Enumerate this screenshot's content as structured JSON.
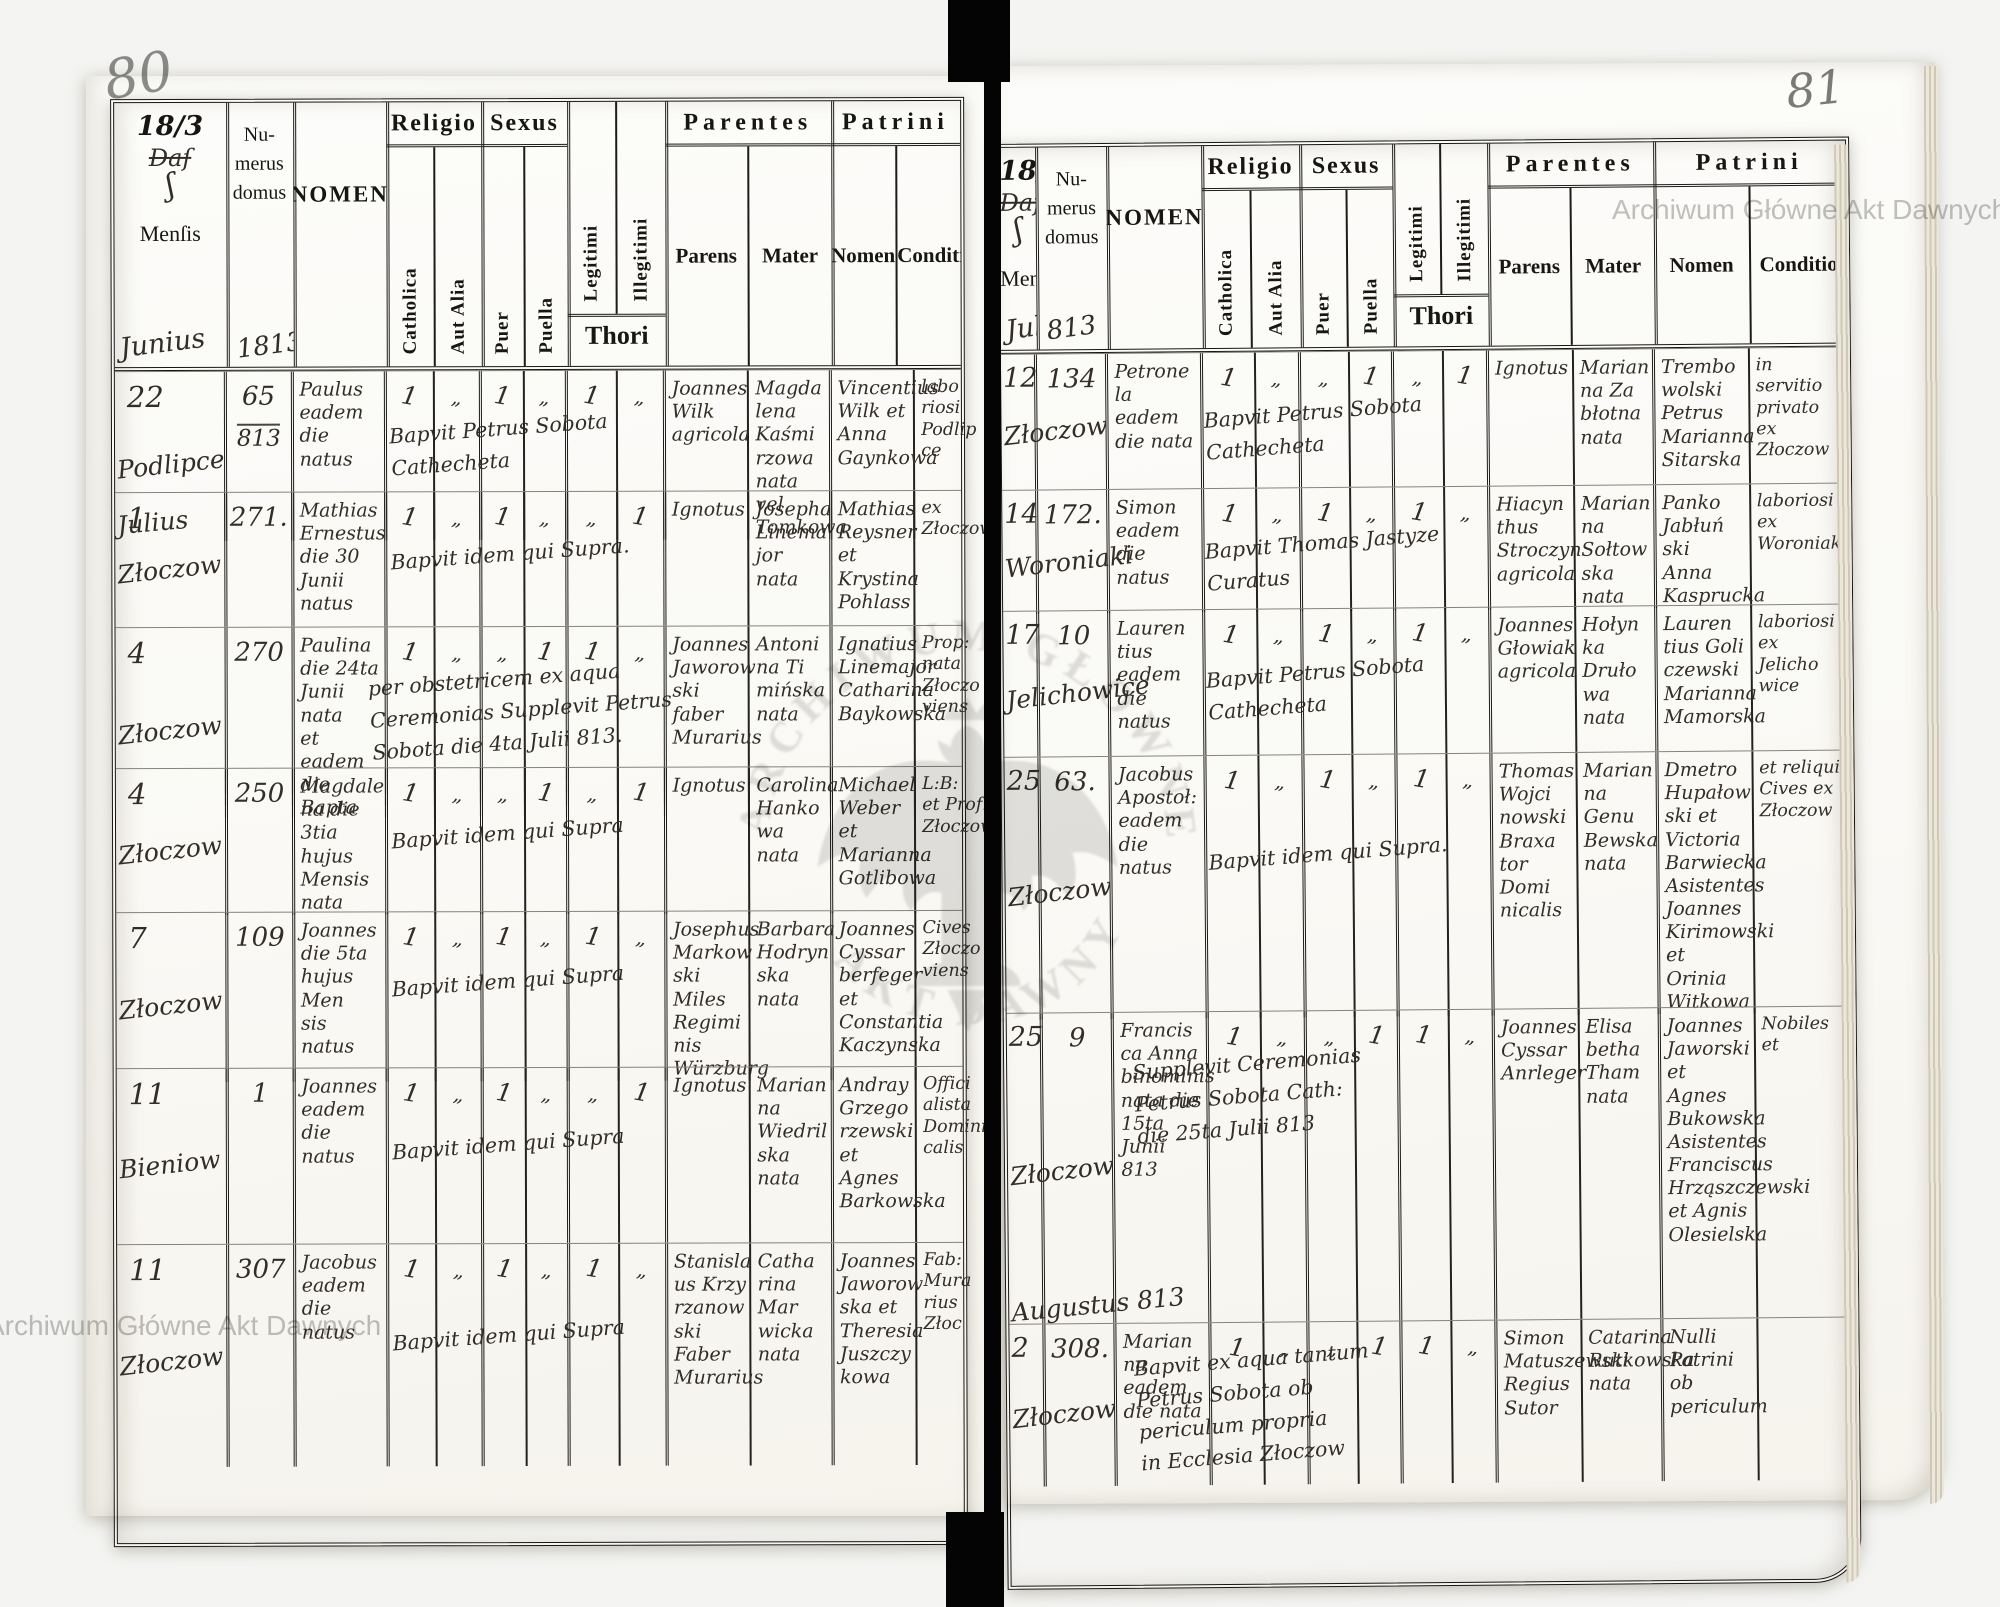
{
  "watermark": {
    "text": "Archiwum Główne Akt Dawnych",
    "emblem_top": "ARCHIWUM GŁÓWNE",
    "emblem_bottom": "AKT DAWNYCH",
    "color": "#c2c2c0"
  },
  "table_headers": {
    "year": "18/3",
    "dat": "Daſ",
    "flourish": "ʃ",
    "mensis": "Menſis",
    "numerus": "Nu-\nmerus\ndomus",
    "nomen": "NOMEN",
    "religio": "Religio",
    "catholica": "Catholica",
    "aut_alia": "Aut Alia",
    "sexus": "Sexus",
    "puer": "Puer",
    "puella": "Puella",
    "legitimi": "Legitimi",
    "illegitimi": "Illegitimi",
    "thori": "Thori",
    "parentes": "Parentes",
    "parens": "Parens",
    "mater": "Mater",
    "patrini": "Patrini",
    "patrini_nomen": "Nomen",
    "conditio": "Conditio"
  },
  "pages": [
    {
      "page_number": "80",
      "mensis_note": "Junius",
      "numerus_note": "1813",
      "rows": [
        {
          "day": "22",
          "place": "Podlipce",
          "month_note": "Julius",
          "numerus": "65",
          "numerus2": "813",
          "nomen": "Paulus\neadem die\nnatus",
          "marks": [
            "1",
            "„",
            "1",
            "„",
            "1",
            "„"
          ],
          "bapt": "Bapvit Petrus Sobota\nCathecheta",
          "parens": "Joannes\nWilk\nagricola",
          "mater": "Magda\nlena\nKaśmi\nrzowa\nnata vel Tomkowa",
          "patrini": "Vincentius\nWilk et\nAnna\nGaynkowa",
          "conditio": "labo\nriosi\nPodlip\nce"
        },
        {
          "day": "1",
          "place": "Złoczow",
          "numerus": "271.",
          "nomen": "Mathias\nErnestus\ndie 30\nJunii natus",
          "marks": [
            "1",
            "„",
            "1",
            "„",
            "„",
            "1"
          ],
          "bapt": "Bapvit idem qui Supra.",
          "parens": "Ignotus",
          "mater": "Josepha\nLinema\njor\nnata",
          "patrini": "Mathias\nReysner et\nKrystina\nPohlass",
          "conditio": "ex\nZłoczow"
        },
        {
          "day": "4",
          "place": "Złoczow",
          "numerus": "270",
          "nomen": "Paulina\ndie 24ta\nJunii nata\net eadem die\nBapta",
          "marks": [
            "1",
            "„",
            "„",
            "1",
            "1",
            "„"
          ],
          "bapt": "per obstetricem ex aqua\nCeremonias Supplevit Petrus\nSobota die 4ta Julii 813.",
          "wide": true,
          "parens": "Joannes\nJaworow\nski faber\nMurarius",
          "mater": "Antoni\nna Ti\nmińska\nnata",
          "patrini": "Ignatius\nLinemajor\nCatharina\nBaykowska",
          "conditio": "Prop:\nnata\nZłoczo\nviens"
        },
        {
          "day": "4",
          "place": "Złoczow",
          "numerus": "250",
          "nomen": "Magdale\nna die\n3tia hujus\nMensis nata",
          "marks": [
            "1",
            "„",
            "„",
            "1",
            "„",
            "1"
          ],
          "bapt": "Bapvit idem qui Supra",
          "parens": "Ignotus",
          "mater": "Carolina\nHanko\nwa\nnata",
          "patrini": "Michael\nWeber et\nMarianna\nGotlibowa",
          "conditio": "L:B:\net Prof:\nZłoczow"
        },
        {
          "day": "7",
          "place": "Złoczow",
          "numerus": "109",
          "nomen": "Joannes\ndie 5ta\nhujus Men\nsis natus",
          "marks": [
            "1",
            "„",
            "1",
            "„",
            "1",
            "„"
          ],
          "bapt": "Bapvit idem qui Supra",
          "parens": "Josephus\nMarkow\nski Miles\nRegimi\nnis\nWürzburg",
          "mater": "Barbara\nHodryn\nska\nnata",
          "patrini": "Joannes\nCyssar\nberfeger et\nConstantia\nKaczynska",
          "conditio": "Cives\nZłoczo\nviens"
        },
        {
          "day": "11",
          "place": "Bieniow",
          "numerus": "1",
          "nomen": "Joannes\neadem\ndie natus",
          "marks": [
            "1",
            "„",
            "1",
            "„",
            "„",
            "1"
          ],
          "bapt": "Bapvit idem qui Supra",
          "parens": "Ignotus",
          "mater": "Marian\nna\nWiedril\nska\nnata",
          "patrini": "Andray\nGrzego\nrzewski\net Agnes\nBarkowska",
          "conditio": "Offici\nalista\nDomini\ncalis"
        },
        {
          "day": "11",
          "place": "Złoczow",
          "numerus": "307",
          "nomen": "Jacobus\neadem die\nnatus",
          "marks": [
            "1",
            "„",
            "1",
            "„",
            "1",
            "„"
          ],
          "bapt": "Bapvit idem qui Supra",
          "parens": "Stanisla\nus Krzy\nrzanow\nski\nFaber\nMurarius",
          "mater": "Catha\nrina\nMar\nwicka\nnata",
          "patrini": "Joannes\nJaworow\nska et\nTheresia\nJuszczy\nkowa",
          "conditio": "Fab:\nMura\nrius\nZłoc"
        }
      ]
    },
    {
      "page_number": "81",
      "mensis_note": "Julius",
      "numerus_note": "813",
      "rows": [
        {
          "day": "12",
          "place": "Złoczow",
          "numerus": "134",
          "nomen": "Petrone\nla eadem\ndie nata",
          "marks": [
            "1",
            "„",
            "„",
            "1",
            "„",
            "1"
          ],
          "bapt": "Bapvit Petrus Sobota\nCathecheta",
          "parens": "Ignotus",
          "mater": "Marian\nna Za\nbłotna\nnata",
          "patrini": "Trembo\nwolski\nPetrus\nMarianna\nSitarska",
          "conditio": "in servitio\nprivato\nex\nZłoczow"
        },
        {
          "day": "14",
          "place": "Woroniaki",
          "numerus": "172.",
          "nomen": "Simon\neadem die\nnatus",
          "marks": [
            "1",
            "„",
            "1",
            "„",
            "1",
            "„"
          ],
          "bapt": "Bapvit Thomas Jastyze\nCuratus",
          "parens": "Hiacyn\nthus\nStroczyn\nagricola",
          "mater": "Marian\nna\nSołtow\nska\nnata",
          "patrini": "Panko\nJabłuń\nski\nAnna\nKasprucka",
          "conditio": "laboriosi\nex\nWoroniaki"
        },
        {
          "day": "17",
          "place": "Jelichowice",
          "numerus": "10",
          "nomen": "Lauren\ntius eadem\ndie natus",
          "marks": [
            "1",
            "„",
            "1",
            "„",
            "1",
            "„"
          ],
          "bapt": "Bapvit Petrus Sobota\nCathecheta",
          "parens": "Joannes\nGłowiak\nagricola",
          "mater": "Hołyn\nka\nDruło\nwa\nnata",
          "patrini": "Lauren\ntius Goli\nczewski\nMarianna\nMamorska",
          "conditio": "laboriosi\nex\nJelicho\nwice"
        },
        {
          "day": "25",
          "place": "Złoczow",
          "numerus": "63.",
          "nomen": "Jacobus\nApostoł:\neadem\ndie natus",
          "marks": [
            "1",
            "„",
            "1",
            "„",
            "1",
            "„"
          ],
          "bapt": "Bapvit idem qui Supra.",
          "parens": "Thomas\nWojci\nnowski\nBraxa\ntor Domi\nnicalis",
          "mater": "Marian\nna\nGenu\nBewska\nnata",
          "patrini": "Dmetro\nHupałow\nski et\nVictoria\nBarwiecka\nAsistentes\nJoannes\nKirimowski et\nOrinia Witkowa",
          "conditio": "et reliqui\nCives ex\nZłoczow"
        },
        {
          "day": "25",
          "place": "Złoczow",
          "month_note": "Augustus 813",
          "numerus": "9",
          "nomen": "Francis\nca Anna\nbinominis\nnata die\n15ta Junii 813",
          "marks": [
            "1",
            "„",
            "„",
            "1",
            "1",
            "„"
          ],
          "bapt": "Supplevit Ceremonias\nPetrus Sobota Cath:\ndie 25ta Julii 813",
          "wide": true,
          "parens": "Joannes\nCyssar\nAnrleger",
          "mater": "Elisa\nbetha\nTham\nnata",
          "patrini": "Joannes\nJaworski et\nAgnes\nBukowska\nAsistentes\nFranciscus\nHrząszczewski\net Agnis\nOlesielska",
          "conditio": "Nobiles et"
        },
        {
          "day": "2",
          "place": "Złoczow",
          "numerus": "308.",
          "nomen": "Marian\nna eadem\ndie nata",
          "marks": [
            "1",
            "„",
            "„",
            "1",
            "1",
            "„"
          ],
          "bapt": "Bapvit ex aqua tantum\nPetrus Sobota ob\npericulum propria\nin Ecclesia Złoczow",
          "wide": true,
          "parens": "Simon\nMatuszewski\nRegius\nSutor",
          "mater": "Catarina\nRutkowska\nnata",
          "patrini": "Nulli Patrini\nob periculum",
          "conditio": ""
        }
      ]
    }
  ]
}
